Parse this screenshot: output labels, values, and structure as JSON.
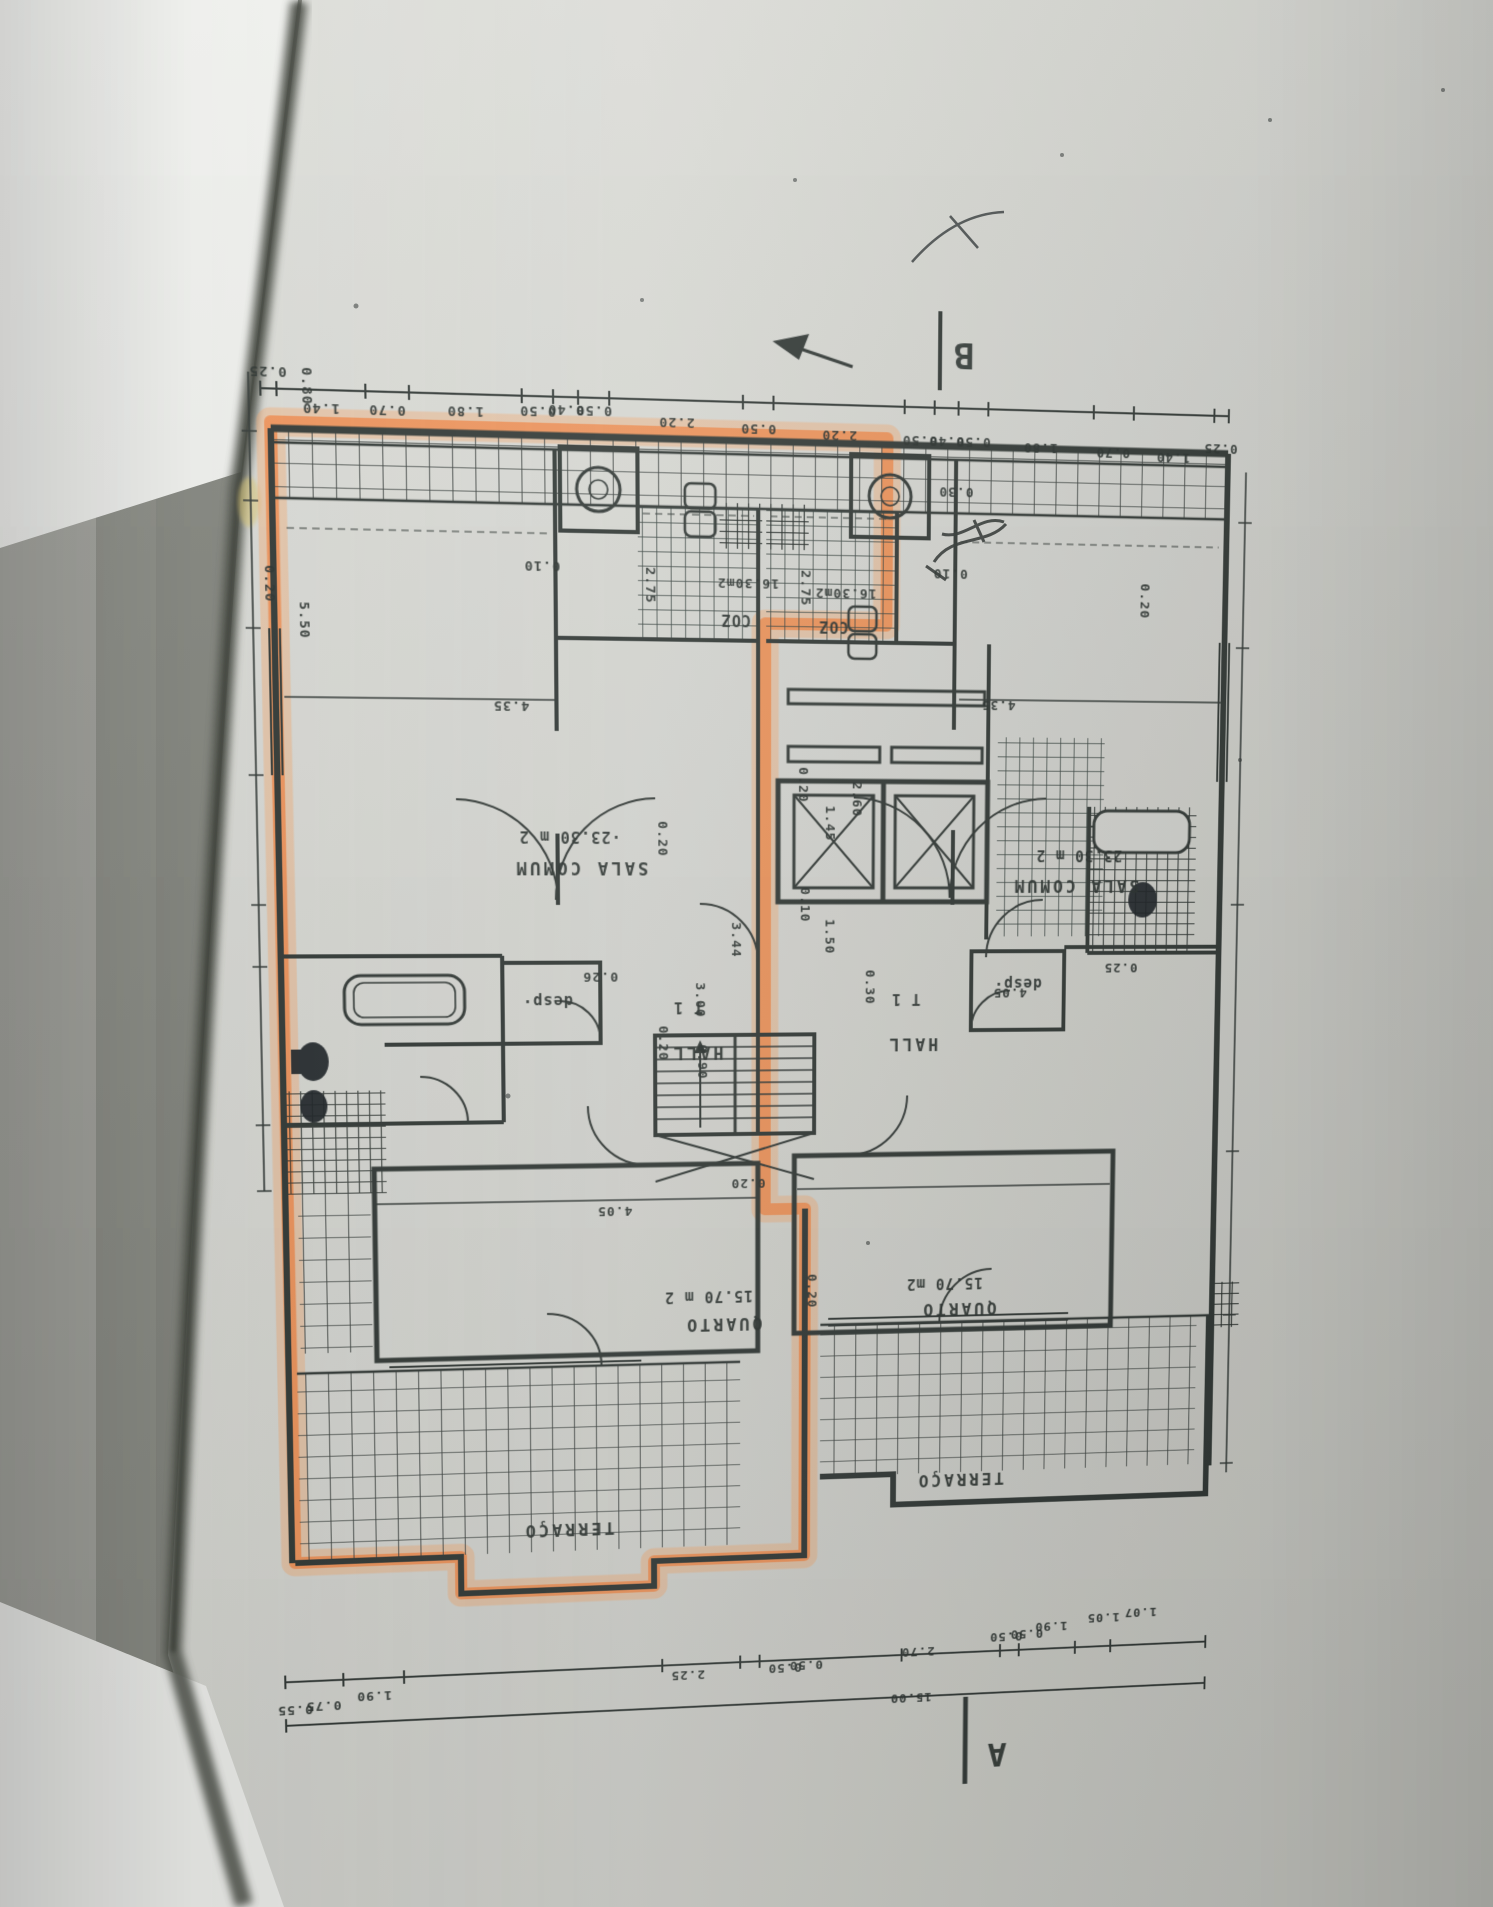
{
  "plan": {
    "section_marks": {
      "top": "B",
      "bottom": "A"
    },
    "rooms": {
      "left": {
        "sala_name": "SALA COMUM",
        "sala_area": "·23.30 m 2",
        "kitchen_name": "COZ",
        "kitchen_area": "16.30m2",
        "hall": "HALL",
        "unit_type": "T 1",
        "pantry": "desp·",
        "bedroom_name": "QUARTO",
        "bedroom_area": "15.70 m 2",
        "terrace": "TERRAÇO"
      },
      "right": {
        "sala_name": "SALA COMUM",
        "sala_area": "23.30 m 2",
        "kitchen_name": "COZ",
        "kitchen_area": "16.30m2",
        "hall": "HALL",
        "unit_type": "T 1",
        "pantry": "desp·",
        "bedroom_name": "QUARTO",
        "bedroom_area": "15.70 m2",
        "terrace": "TERRAÇO"
      }
    },
    "dims_top": [
      "0.25",
      "1.40",
      "0.70",
      "1.80",
      "0.50",
      "0.40",
      "0.50",
      "2.20",
      "0.50",
      "2.20",
      "0.50",
      "0.40",
      "0.50",
      "1.80",
      "0.70",
      "1.40",
      "0.25"
    ],
    "dims_bottom": [
      "0.55",
      "0.75",
      "1.90",
      "2.25",
      "0.50",
      "0.50",
      "2.70",
      "0.50",
      "0.50",
      "1.90",
      "1.05",
      "1.07"
    ],
    "total_length": "15.00",
    "dims_side": [
      "0.80",
      "0.20",
      "5.50",
      "0.10",
      "2.75",
      "0.30",
      "2.75",
      "0.10",
      "4.35",
      "4.35",
      "0.20",
      "0.20",
      "1.45",
      "0.10",
      "1.50",
      "2.60",
      "0.20",
      "3.44",
      "3.00",
      "0.90",
      "0.20",
      "0.26",
      "4.05",
      "0.20",
      "0.20",
      "0.30",
      "4.05",
      "0.25"
    ],
    "colors": {
      "highlight": "#f08a4a",
      "ink": "#333a37",
      "paper": "#d6d7d2"
    }
  }
}
